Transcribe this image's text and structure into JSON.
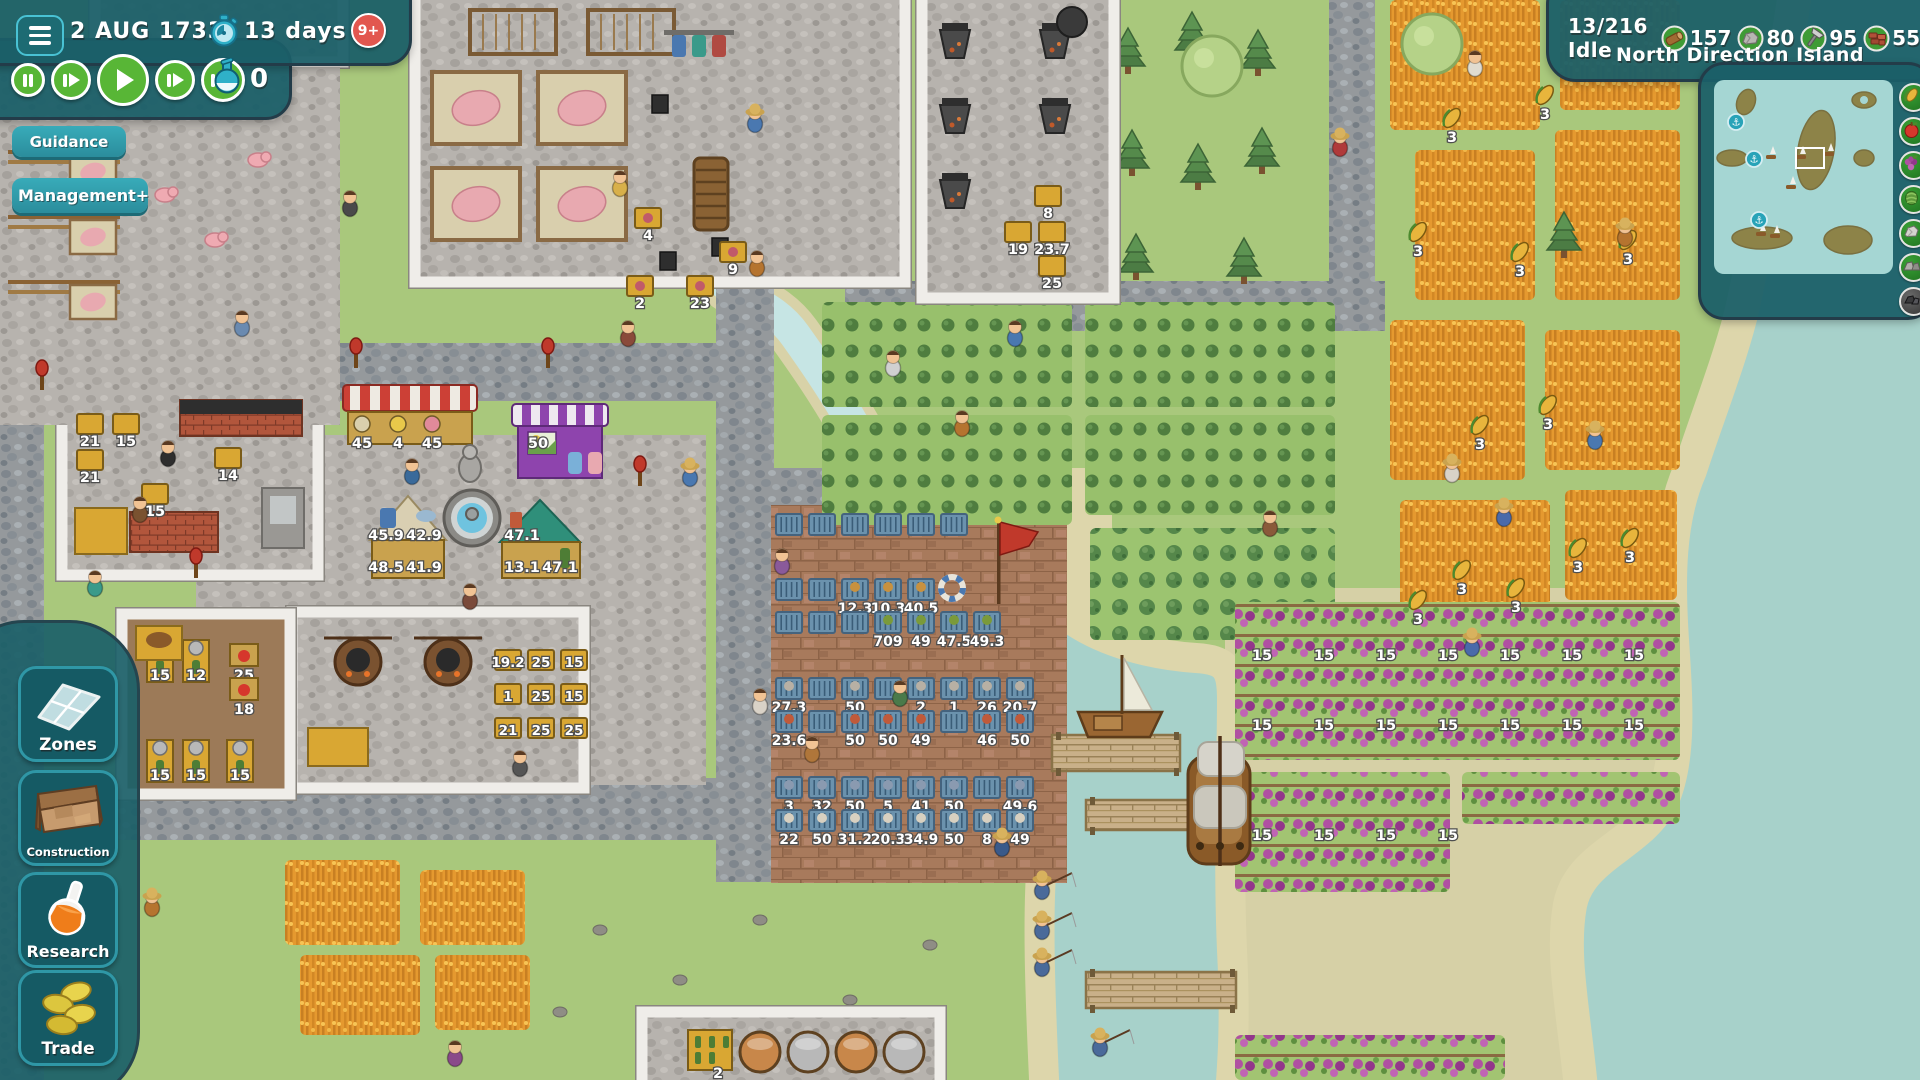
{
  "topbar": {
    "date": "2 AUG 1733",
    "timer": "13 days",
    "notification_badge": "9+",
    "science_points": "0",
    "guidance_label": "Guidance",
    "management_label": "Management+"
  },
  "status": {
    "idle": "13/216 Idle",
    "resources": [
      {
        "id": "wood",
        "value": "157"
      },
      {
        "id": "stone",
        "value": "80"
      },
      {
        "id": "tools",
        "value": "95"
      },
      {
        "id": "bricks",
        "value": "55"
      }
    ],
    "island": "North Direction Island"
  },
  "minimap": {
    "rail_icons": [
      "corn",
      "apple",
      "grapes",
      "cabbage",
      "stone",
      "rocks",
      "coal"
    ],
    "anchor_count": 3
  },
  "sidebar": [
    {
      "id": "zones",
      "label": "Zones"
    },
    {
      "id": "construction",
      "label": "Construction"
    },
    {
      "id": "research",
      "label": "Research"
    },
    {
      "id": "trade",
      "label": "Trade"
    }
  ],
  "world": {
    "storage_rows": [
      [
        "",
        "",
        "",
        "",
        "",
        ""
      ],
      [
        "",
        "",
        "12.3",
        "10.3",
        "40.5",
        null
      ],
      [
        "",
        "",
        "",
        "709",
        "49",
        "47.5",
        "49.3"
      ],
      [
        "27.3",
        "",
        "50",
        "",
        "2",
        "1",
        "26",
        "20.7"
      ],
      [
        "23.6",
        "",
        "50",
        "50",
        "49",
        "",
        "46",
        "50"
      ],
      [
        "3",
        "32",
        "50",
        "5",
        "41",
        "50",
        "",
        "49.6"
      ],
      [
        "22",
        "50",
        "31.2",
        "20.3",
        "34.9",
        "50",
        "8",
        "49"
      ]
    ],
    "stall_red": [
      "45",
      "4",
      "45"
    ],
    "stall_purple": [
      "50"
    ],
    "stall_tan": [
      "45.9",
      "42.9",
      "48.5",
      "41.9"
    ],
    "stall_teal": [
      "47.1",
      "13.1",
      "47.1"
    ],
    "kitchen_crates": [
      "21",
      "15",
      "21",
      "14",
      "15"
    ],
    "press_labels": [
      "15",
      "12",
      "25",
      "18",
      "15",
      "15",
      "15"
    ],
    "tavern_crates": [
      [
        "19.2",
        "25",
        "15"
      ],
      [
        "1",
        "25",
        "15"
      ],
      [
        "21",
        "25",
        "25"
      ]
    ],
    "smelter_crates": [
      "8",
      "19",
      "23.7",
      "25"
    ],
    "mill_crates": [
      "4",
      "9",
      "2",
      "23"
    ],
    "brewery_label": "2",
    "grape_label": "15",
    "corn_label": "3"
  },
  "colors": {
    "grass": "#a9c87c",
    "sea": "#a7d1ca",
    "river": "#c6e5e4",
    "sand": "#ddd6ab",
    "accent_teal": "#2f97a6",
    "button_green": "#58b636",
    "badge_red": "#e2574f"
  }
}
